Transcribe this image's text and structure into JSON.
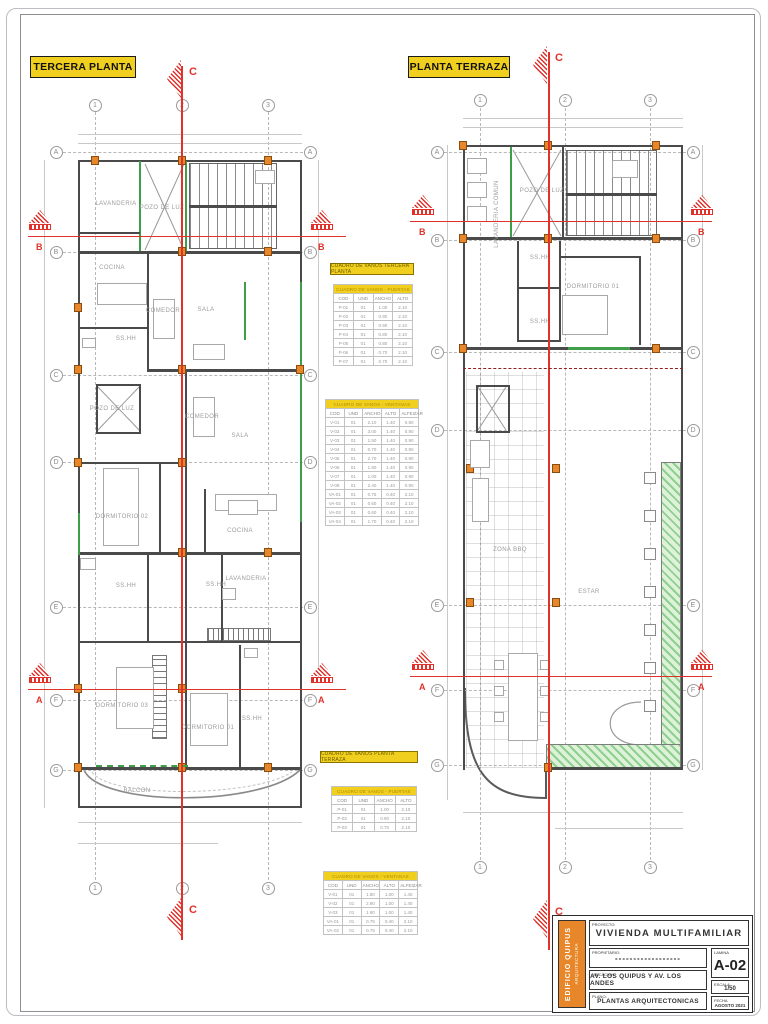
{
  "page": {
    "plan_left_title": "TERCERA PLANTA",
    "plan_right_title": "PLANTA TERRAZA"
  },
  "grid": {
    "numbers": [
      "1",
      "2",
      "3"
    ],
    "letters": [
      "A",
      "B",
      "C",
      "D",
      "E",
      "F",
      "G"
    ]
  },
  "sections": {
    "a": "A",
    "b": "B",
    "c": "C"
  },
  "rooms_tercera": [
    "LAVANDERIA",
    "POZO DE LUZ",
    "COCINA",
    "COMEDOR",
    "SALA",
    "SS.HH",
    "POZO DE LUZ",
    "COMEDOR",
    "SALA",
    "DORMITORIO 02",
    "COCINA",
    "SS.HH",
    "SS.HH",
    "LAVANDERIA",
    "DORMITORIO 03",
    "DORMITORIO 01",
    "SS.HH",
    "BALCON"
  ],
  "rooms_terraza": [
    "LAVANDERIA COMUN",
    "POZO DE LUZ",
    "SS.HH",
    "DORMITORIO 01",
    "SS.HH",
    "ZONA BBQ",
    "ESTAR"
  ],
  "tables": {
    "tercera_title": "CUADRO DE VANOS TERCERA PLANTA",
    "terraza_title": "CUADRO DE VANOS PLANTA TERRAZA",
    "tercera_puertas": {
      "banner": "CUADRO DE VANOS - PUERTAS",
      "headers": [
        "COD",
        "UND",
        "ANCHO",
        "ALTO"
      ],
      "rows": [
        [
          "P-01",
          "01",
          "1.00",
          "2.10"
        ],
        [
          "P-02",
          "01",
          "0.90",
          "2.10"
        ],
        [
          "P-03",
          "01",
          "0.90",
          "2.10"
        ],
        [
          "P-04",
          "01",
          "0.80",
          "2.10"
        ],
        [
          "P-05",
          "01",
          "0.80",
          "2.10"
        ],
        [
          "P-06",
          "01",
          "0.70",
          "2.10"
        ],
        [
          "P-07",
          "01",
          "0.70",
          "2.10"
        ]
      ]
    },
    "tercera_ventanas": {
      "banner": "CUADRO DE VANOS - VENTANAS",
      "headers": [
        "COD",
        "UND",
        "ANCHO",
        "ALTO",
        "ALFEIZAR"
      ],
      "rows": [
        [
          "V-01",
          "01",
          "2.10",
          "1.40",
          "0.90"
        ],
        [
          "V-02",
          "01",
          "3.00",
          "1.40",
          "0.90"
        ],
        [
          "V-03",
          "01",
          "1.50",
          "1.40",
          "0.90"
        ],
        [
          "V-04",
          "01",
          "0.70",
          "1.40",
          "0.90"
        ],
        [
          "V-05",
          "01",
          "2.70",
          "1.40",
          "0.90"
        ],
        [
          "V-06",
          "01",
          "1.80",
          "1.40",
          "0.90"
        ],
        [
          "V-07",
          "01",
          "1.00",
          "1.40",
          "0.90"
        ],
        [
          "V-08",
          "01",
          "2.40",
          "1.40",
          "0.90"
        ],
        [
          "VA-01",
          "01",
          "0.75",
          "0.40",
          "2.10"
        ],
        [
          "VA-02",
          "01",
          "0.60",
          "0.40",
          "2.10"
        ],
        [
          "VA-03",
          "01",
          "0.60",
          "0.40",
          "2.10"
        ],
        [
          "VA-04",
          "01",
          "1.70",
          "0.40",
          "2.10"
        ]
      ]
    },
    "terraza_puertas": {
      "banner": "CUADRO DE VANOS - PUERTAS",
      "headers": [
        "COD",
        "UND",
        "ANCHO",
        "ALTO"
      ],
      "rows": [
        [
          "P-01",
          "01",
          "1.00",
          "2.10"
        ],
        [
          "P-02",
          "01",
          "0.90",
          "2.10"
        ],
        [
          "P-03",
          "01",
          "0.70",
          "2.10"
        ]
      ]
    },
    "terraza_ventanas": {
      "banner": "CUADRO DE VANOS - VENTANAS",
      "headers": [
        "COD",
        "UND",
        "ANCHO",
        "ALTO",
        "ALFEIZAR"
      ],
      "rows": [
        [
          "V-01",
          "01",
          "1.80",
          "1.00",
          "1.40"
        ],
        [
          "V-02",
          "01",
          "2.90",
          "1.00",
          "1.40"
        ],
        [
          "V-03",
          "01",
          "1.90",
          "1.00",
          "1.40"
        ],
        [
          "VA-01",
          "01",
          "0.75",
          "0.40",
          "2.10"
        ],
        [
          "VA-02",
          "01",
          "0.75",
          "0.40",
          "2.10"
        ]
      ]
    }
  },
  "titleblock": {
    "labels": {
      "proyecto": "PROYECTO:",
      "propietario": "PROPIETARIO:",
      "ubicacion": "UBICACION:",
      "plano": "PLANO:",
      "lamina": "LAMINA",
      "escala": "ESCALA",
      "fecha": "FECHA"
    },
    "proyecto": "VIVIENDA MULTIFAMILIAR",
    "propietario": "------------------",
    "ubicacion": "AV. LOS QUIPUS Y AV. LOS ANDES",
    "plano": "PLANTAS ARQUITECTONICAS",
    "lamina": "A-02",
    "escala": "1/50",
    "fecha": "AGOSTO 2021",
    "strip_line1": "EDIFICIO QUIPUS",
    "strip_line2": "ARQUITECTURA"
  },
  "colors": {
    "label_yellow": "#f0cf1e",
    "column_orange": "#e8872a",
    "section_red": "#e0322a",
    "wall_green": "#3f9e49",
    "planter_green": "#bfe3b4",
    "wall_gray": "#4a4a4a"
  }
}
